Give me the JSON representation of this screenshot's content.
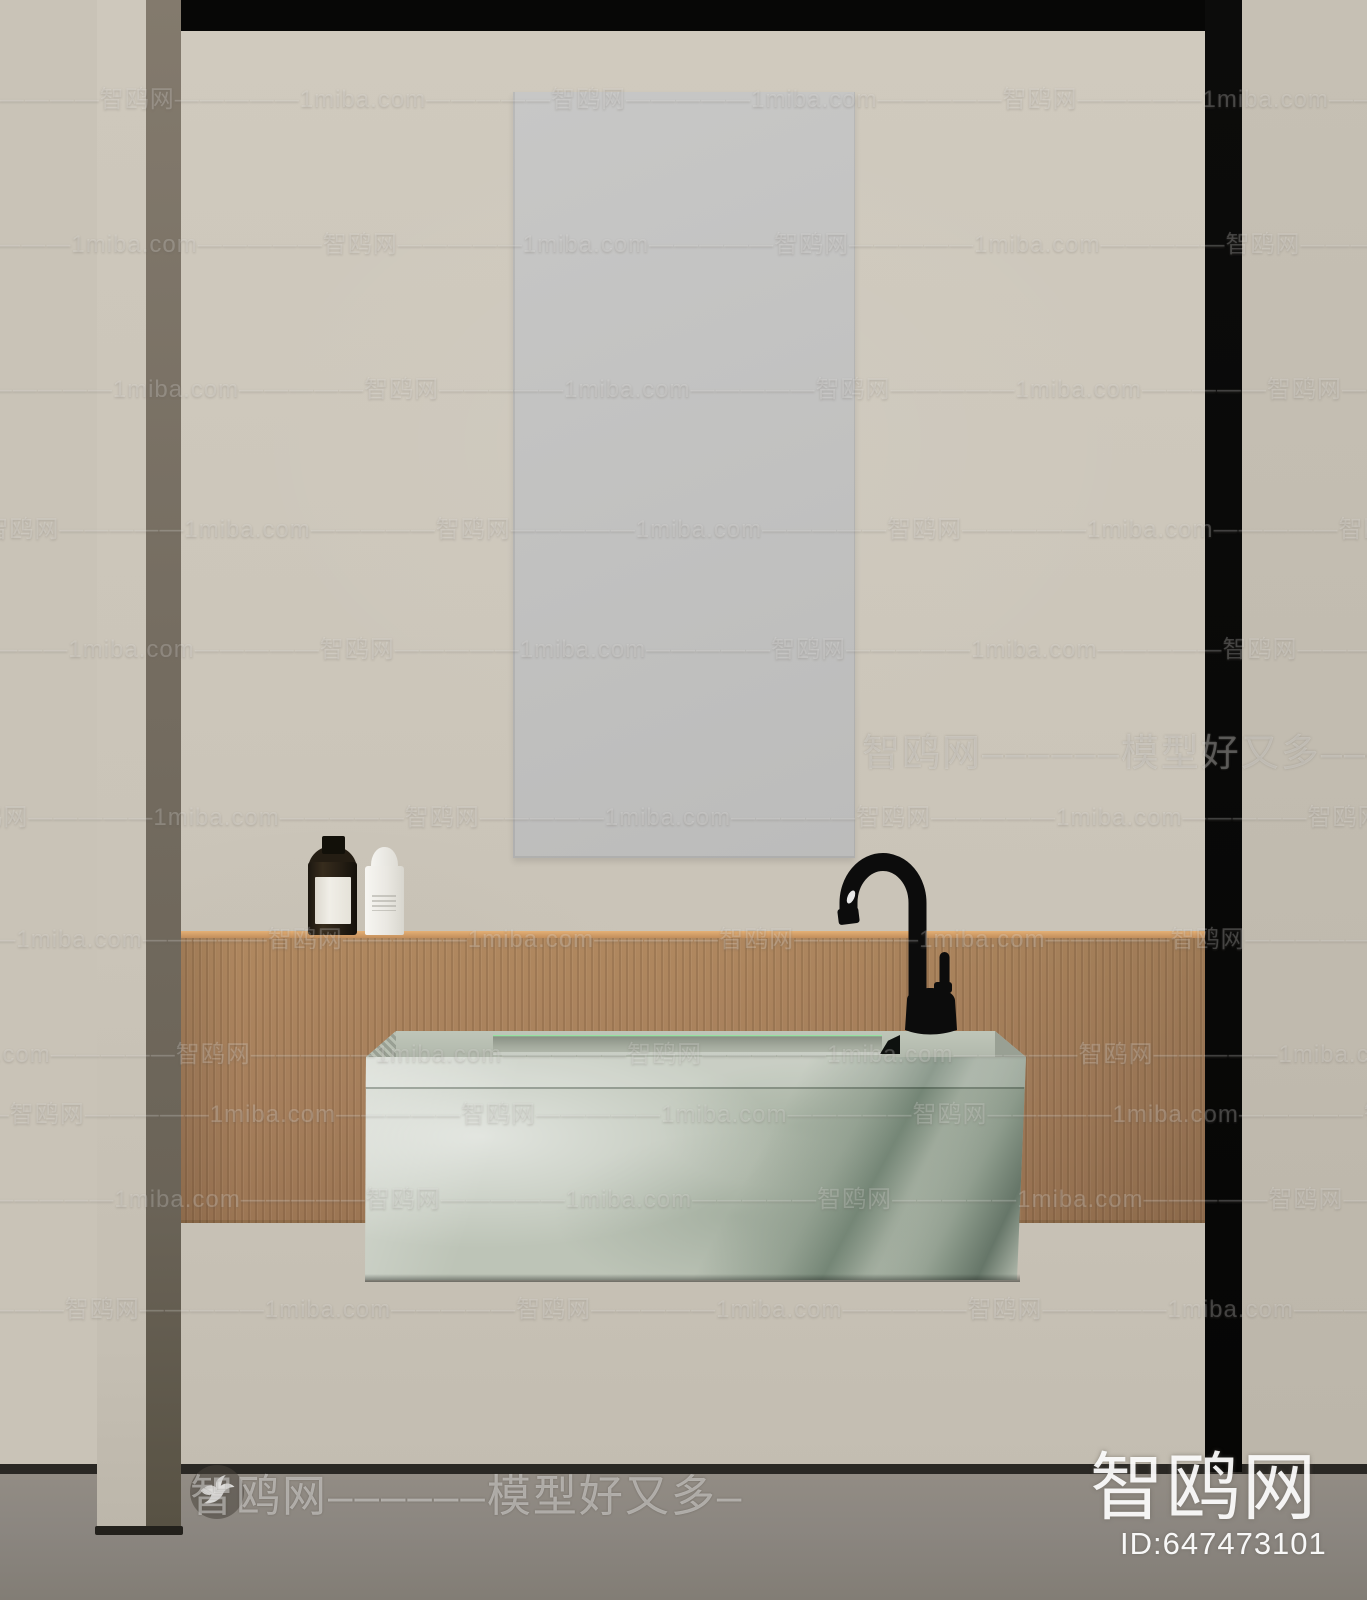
{
  "watermarks": {
    "tile": {
      "site_en": "1miba.com",
      "dashes": "—————",
      "site_cn": "智鸥网"
    },
    "rows": [
      {
        "y": 95,
        "x": -133
      },
      {
        "y": 240,
        "x": 90
      },
      {
        "y": 385,
        "x": -320
      },
      {
        "y": 525,
        "x": 203
      },
      {
        "y": 645,
        "x": 87
      },
      {
        "y": 813,
        "x": 172
      },
      {
        "y": 935,
        "x": 35
      },
      {
        "y": 1050,
        "x": -57
      },
      {
        "y": 1110,
        "x": -223
      },
      {
        "y": 1195,
        "x": 133
      },
      {
        "y": 1305,
        "x": -168
      }
    ],
    "band1_text": "智鸥网––––––模型好又多––––––––",
    "band2_text": "智鸥网––––––模型好又多–",
    "logo_text": "智鸥网",
    "model_id": "ID:647473101",
    "bird_icon": "seagull"
  },
  "colors": {
    "wall_outer_left": "#c9c3b7",
    "wall_outer_right": "#c1bbaf",
    "wall_inner": "#ccc6ba",
    "frame_black": "#070706",
    "post_front": "#cac4b8",
    "post_side": "#746c60",
    "mirror": "#c2c2c1",
    "wood": "#a67f5c",
    "wood_edge": "#d9a56d",
    "floor": "#8b8680",
    "skirting": "#2a2824",
    "marble_base": "#bdc4b7",
    "marble_vein": "#445244",
    "basin": "#a4ab9e",
    "faucet": "#0c0c0c",
    "bottle_dark": "#251e14",
    "bottle_label": "#eceae2",
    "bottle_white": "#eeece6",
    "watermark": "#ffffff"
  }
}
